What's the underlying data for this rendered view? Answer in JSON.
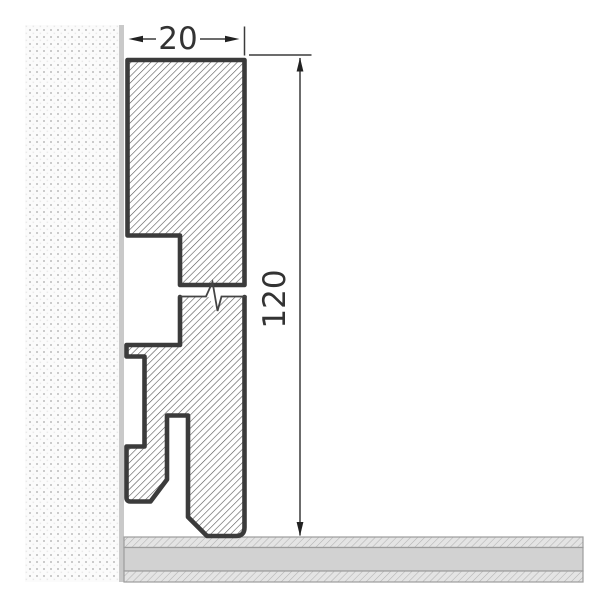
{
  "diagram": {
    "type": "technical-drawing-skirting-board-cross-section",
    "dimensions": {
      "width": {
        "label": "20",
        "value": 20
      },
      "height": {
        "label": "120",
        "value": 120
      }
    },
    "elements": {
      "wall": "dotted-wall-texture",
      "wall_edge": "wall-surface-line",
      "floor": "layered-floor-band",
      "profile": "hatched-skirting-profile",
      "break_symbol": "zigzag-break-line"
    },
    "colors": {
      "outline": "#3b3b3b",
      "hatch_line": "#515151",
      "wall_edge": "#c9c9c9",
      "wall_dot": "#cbcbcb",
      "floor_solid": "#d2d2d2",
      "floor_hatch_bg": "#e4e4e4",
      "floor_border": "#9c9c9c",
      "dimension_line": "#333333",
      "background": "#ffffff"
    }
  }
}
